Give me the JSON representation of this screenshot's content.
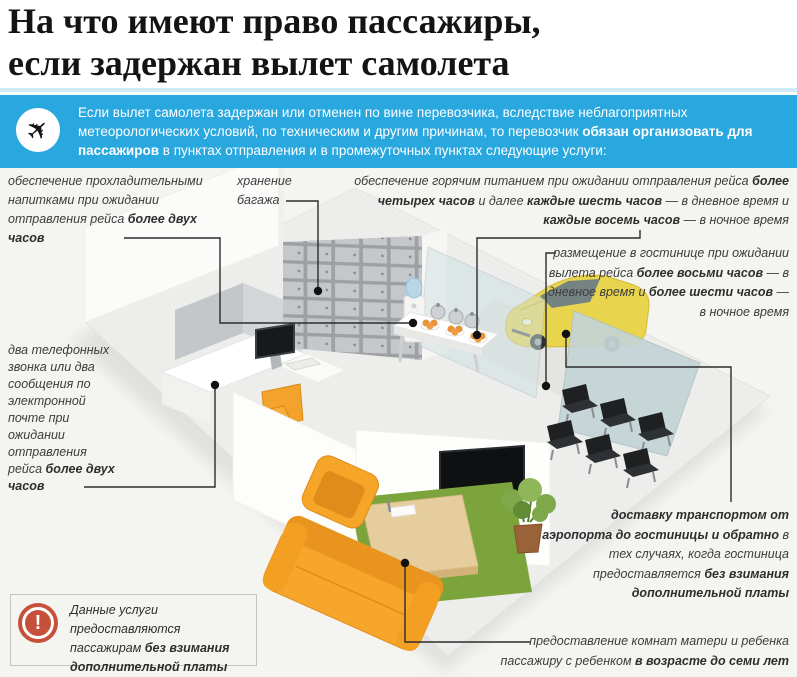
{
  "title": {
    "line1": "На что имеют право пассажиры,",
    "line2": "если задержан вылет самолета"
  },
  "banner": {
    "icon": "airplane-icon",
    "runs": [
      {
        "t": "Если вылет самолета задержан или отменен по вине перевозчика, вследствие неблагоприятных метеорологических условий, по техническим и другим причинам, то перевозчик ",
        "b": false
      },
      {
        "t": "обязан организовать для пассажиров",
        "b": true
      },
      {
        "t": " в пунктах отправления и в промежуточных пунктах следующие услуги:",
        "b": false
      }
    ]
  },
  "callouts": {
    "refreshments": {
      "runs": [
        {
          "t": "обеспечение прохладительными напитками при ожидании отправления рейса ",
          "b": false
        },
        {
          "t": "более двух часов",
          "b": true
        }
      ]
    },
    "baggage": {
      "runs": [
        {
          "t": "хранение багажа",
          "b": false
        }
      ]
    },
    "hot_meals": {
      "runs": [
        {
          "t": "обеспечение горячим питанием при ожидании отправления рейса ",
          "b": false
        },
        {
          "t": "более четырех часов",
          "b": true
        },
        {
          "t": " и далее ",
          "b": false
        },
        {
          "t": "каждые шесть часов",
          "b": true
        },
        {
          "t": " — в дневное время и ",
          "b": false
        },
        {
          "t": "каждые восемь часов",
          "b": true
        },
        {
          "t": " — в ночное время",
          "b": false
        }
      ]
    },
    "hotel": {
      "runs": [
        {
          "t": "размещение в гостинице при ожидании вылета рейса ",
          "b": false
        },
        {
          "t": "более восьми часов",
          "b": true
        },
        {
          "t": " — в дневное время и ",
          "b": false
        },
        {
          "t": "более шести часов",
          "b": true
        },
        {
          "t": " — в ночное время",
          "b": false
        }
      ]
    },
    "phone": {
      "runs": [
        {
          "t": "два телефонных звонка или два сообщения по электронной почте при ожидании отправления рейса ",
          "b": false
        },
        {
          "t": "более двух часов",
          "b": true
        }
      ]
    },
    "transport": {
      "runs": [
        {
          "t": "доставку транспортом от аэропорта до гостиницы и обратно",
          "b": true
        },
        {
          "t": " в тех случаях, когда гостиница предоставляется ",
          "b": false
        },
        {
          "t": "без взимания дополнительной платы",
          "b": true
        }
      ]
    },
    "mother_child": {
      "runs": [
        {
          "t": "предоставление комнат матери и ребенка пассажиру с ребенком ",
          "b": false
        },
        {
          "t": "в возрасте до семи лет",
          "b": true
        }
      ]
    }
  },
  "note": {
    "icon": "warning-exclamation-icon",
    "runs": [
      {
        "t": "Данные услуги предоставляются пассажирам ",
        "b": false
      },
      {
        "t": "без взимания дополнительной платы",
        "b": true
      }
    ]
  },
  "scene_objects": [
    "baggage-lockers",
    "water-cooler",
    "buffet-table",
    "reception-desk",
    "computer-monitor",
    "office-chair",
    "taxi-car",
    "glass-partition",
    "partition-wall",
    "tv-wall",
    "tv-screen",
    "sofa",
    "armchair",
    "rug",
    "play-mat",
    "potted-plant",
    "waiting-seats"
  ],
  "colors": {
    "banner_blue": "#29a7df",
    "title_black": "#141414",
    "label_gray": "#3c3c3c",
    "warning_red": "#c7503a",
    "furniture_orange": "#f6a62a",
    "rug_green": "#7ca43c",
    "taxi_yellow": "#e9d44e",
    "section_bg": "#f4f4f1"
  }
}
